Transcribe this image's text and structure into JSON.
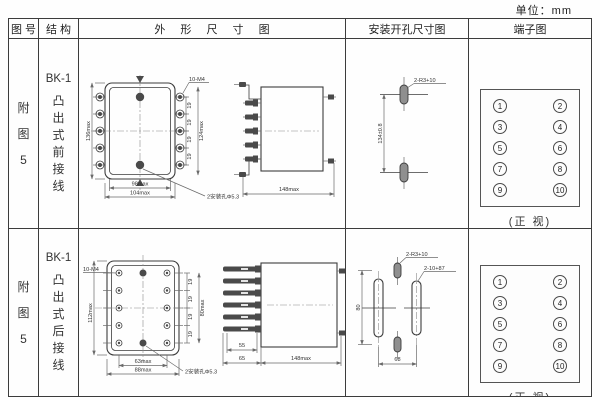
{
  "page": {
    "unit_label": "单位：mm"
  },
  "table": {
    "headers": {
      "fig_no": "图 号",
      "structure": "结 构",
      "outline": "外 形 尺 寸 图",
      "mounting": "安装开孔尺寸图",
      "terminal": "端子图"
    },
    "rows": [
      {
        "fig_no": [
          "附",
          "图",
          "5"
        ],
        "structure": {
          "model": "BK-1",
          "desc": [
            "凸",
            "出",
            "式",
            "前",
            "接",
            "线"
          ]
        },
        "outline": {
          "front": {
            "height_dim": "136max",
            "right_dim": "124max",
            "thread_label": "10-M4",
            "pitch": [
              "19",
              "19",
              "19",
              "19"
            ],
            "bottom_inner_dim": "98max",
            "bottom_outer_dim": "104max",
            "hole_label": "2安装孔Φ5.3"
          },
          "side": {
            "depth_dim": "148max"
          }
        },
        "mounting": {
          "vertical_dim": "134±0.8",
          "slot_label": "2-R3+10"
        },
        "terminal": {
          "left": [
            "1",
            "3",
            "5",
            "7",
            "9"
          ],
          "right": [
            "2",
            "4",
            "6",
            "8",
            "10"
          ],
          "caption": "(正 视)"
        }
      },
      {
        "fig_no": [
          "附",
          "图",
          "5"
        ],
        "structure": {
          "model": "BK-1",
          "desc": [
            "凸",
            "出",
            "式",
            "后",
            "接",
            "线"
          ]
        },
        "outline": {
          "front": {
            "thread_label": "10-M4",
            "height_dim": "112max",
            "right_dim": "80max",
            "pitch": [
              "19",
              "19",
              "19",
              "19"
            ],
            "bottom_inner_dim": "63max",
            "bottom_outer_dim": "88max",
            "hole_label": "2安装孔Φ5.3"
          },
          "side": {
            "blade_dim": "55",
            "base_dim": "65",
            "depth_dim": "148max"
          }
        },
        "mounting": {
          "small_slot_label": "2-R3+10",
          "big_slot_label": "2-10+87",
          "vertical_dim": "80",
          "bottom_dim": "68"
        },
        "terminal": {
          "left": [
            "1",
            "3",
            "5",
            "7",
            "9"
          ],
          "right": [
            "2",
            "4",
            "6",
            "8",
            "10"
          ],
          "caption": "(正 视)"
        }
      }
    ]
  }
}
